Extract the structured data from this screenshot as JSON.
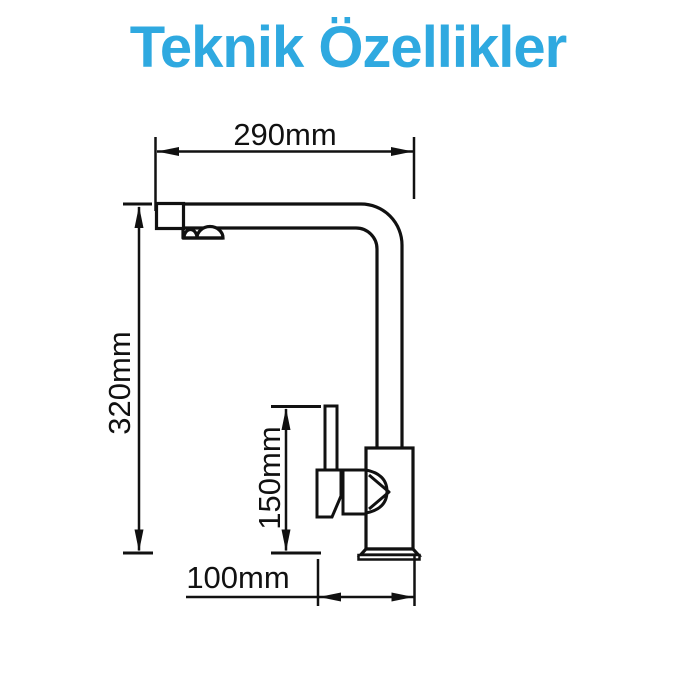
{
  "title": "Teknik Özellikler",
  "colors": {
    "title_blue": "#2FA9E0",
    "drawing_line": "#111111",
    "background": "#ffffff"
  },
  "diagram": {
    "type": "technical-drawing",
    "dimensions": {
      "spout_reach": {
        "label": "290mm",
        "orientation": "horizontal"
      },
      "total_height": {
        "label": "320mm",
        "orientation": "vertical"
      },
      "handle_height": {
        "label": "150mm",
        "orientation": "vertical"
      },
      "base_offset": {
        "label": "100mm",
        "orientation": "horizontal"
      }
    }
  }
}
